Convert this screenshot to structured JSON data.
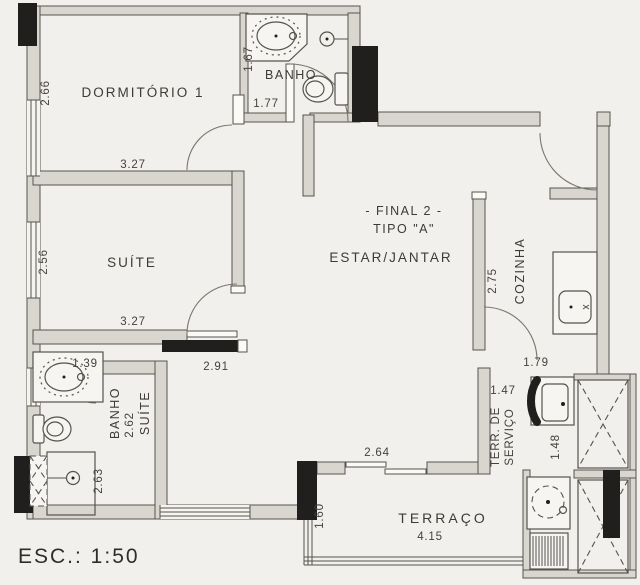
{
  "plan": {
    "scale": "ESC.: 1:50",
    "rooms": {
      "dormitorio1": {
        "name": "DORMITÓRIO 1",
        "dim_w": "3.27",
        "dim_h": "2.66"
      },
      "banho": {
        "name": "BANHO",
        "dim_w": "1.77",
        "dim_h": "1.67"
      },
      "suite": {
        "name": "SUÍTE",
        "dim_w": "3.27",
        "dim_h": "2.56"
      },
      "estar": {
        "heading": "- FINAL 2 -",
        "subheading": "TIPO \"A\"",
        "name": "ESTAR/JANTAR",
        "dim_wall": "2.75",
        "dim_beam": "2.91",
        "dim_h": "2.62"
      },
      "cozinha": {
        "name": "COZINHA"
      },
      "banho_suite": {
        "name_line1": "BANHO",
        "name_line2": "SUÍTE",
        "dim_hall": "1.39",
        "dim_h": "2.63"
      },
      "servico": {
        "name_line1": "TERR. DE",
        "name_line2": "SERVIÇO",
        "dim_door": "1.79",
        "dim_w": "1.47",
        "dim_shaft": "1.48"
      },
      "terraco": {
        "name": "TERRAÇO",
        "dim_w": "4.15",
        "dim_h": "1.60",
        "dim_door": "2.64"
      }
    }
  }
}
